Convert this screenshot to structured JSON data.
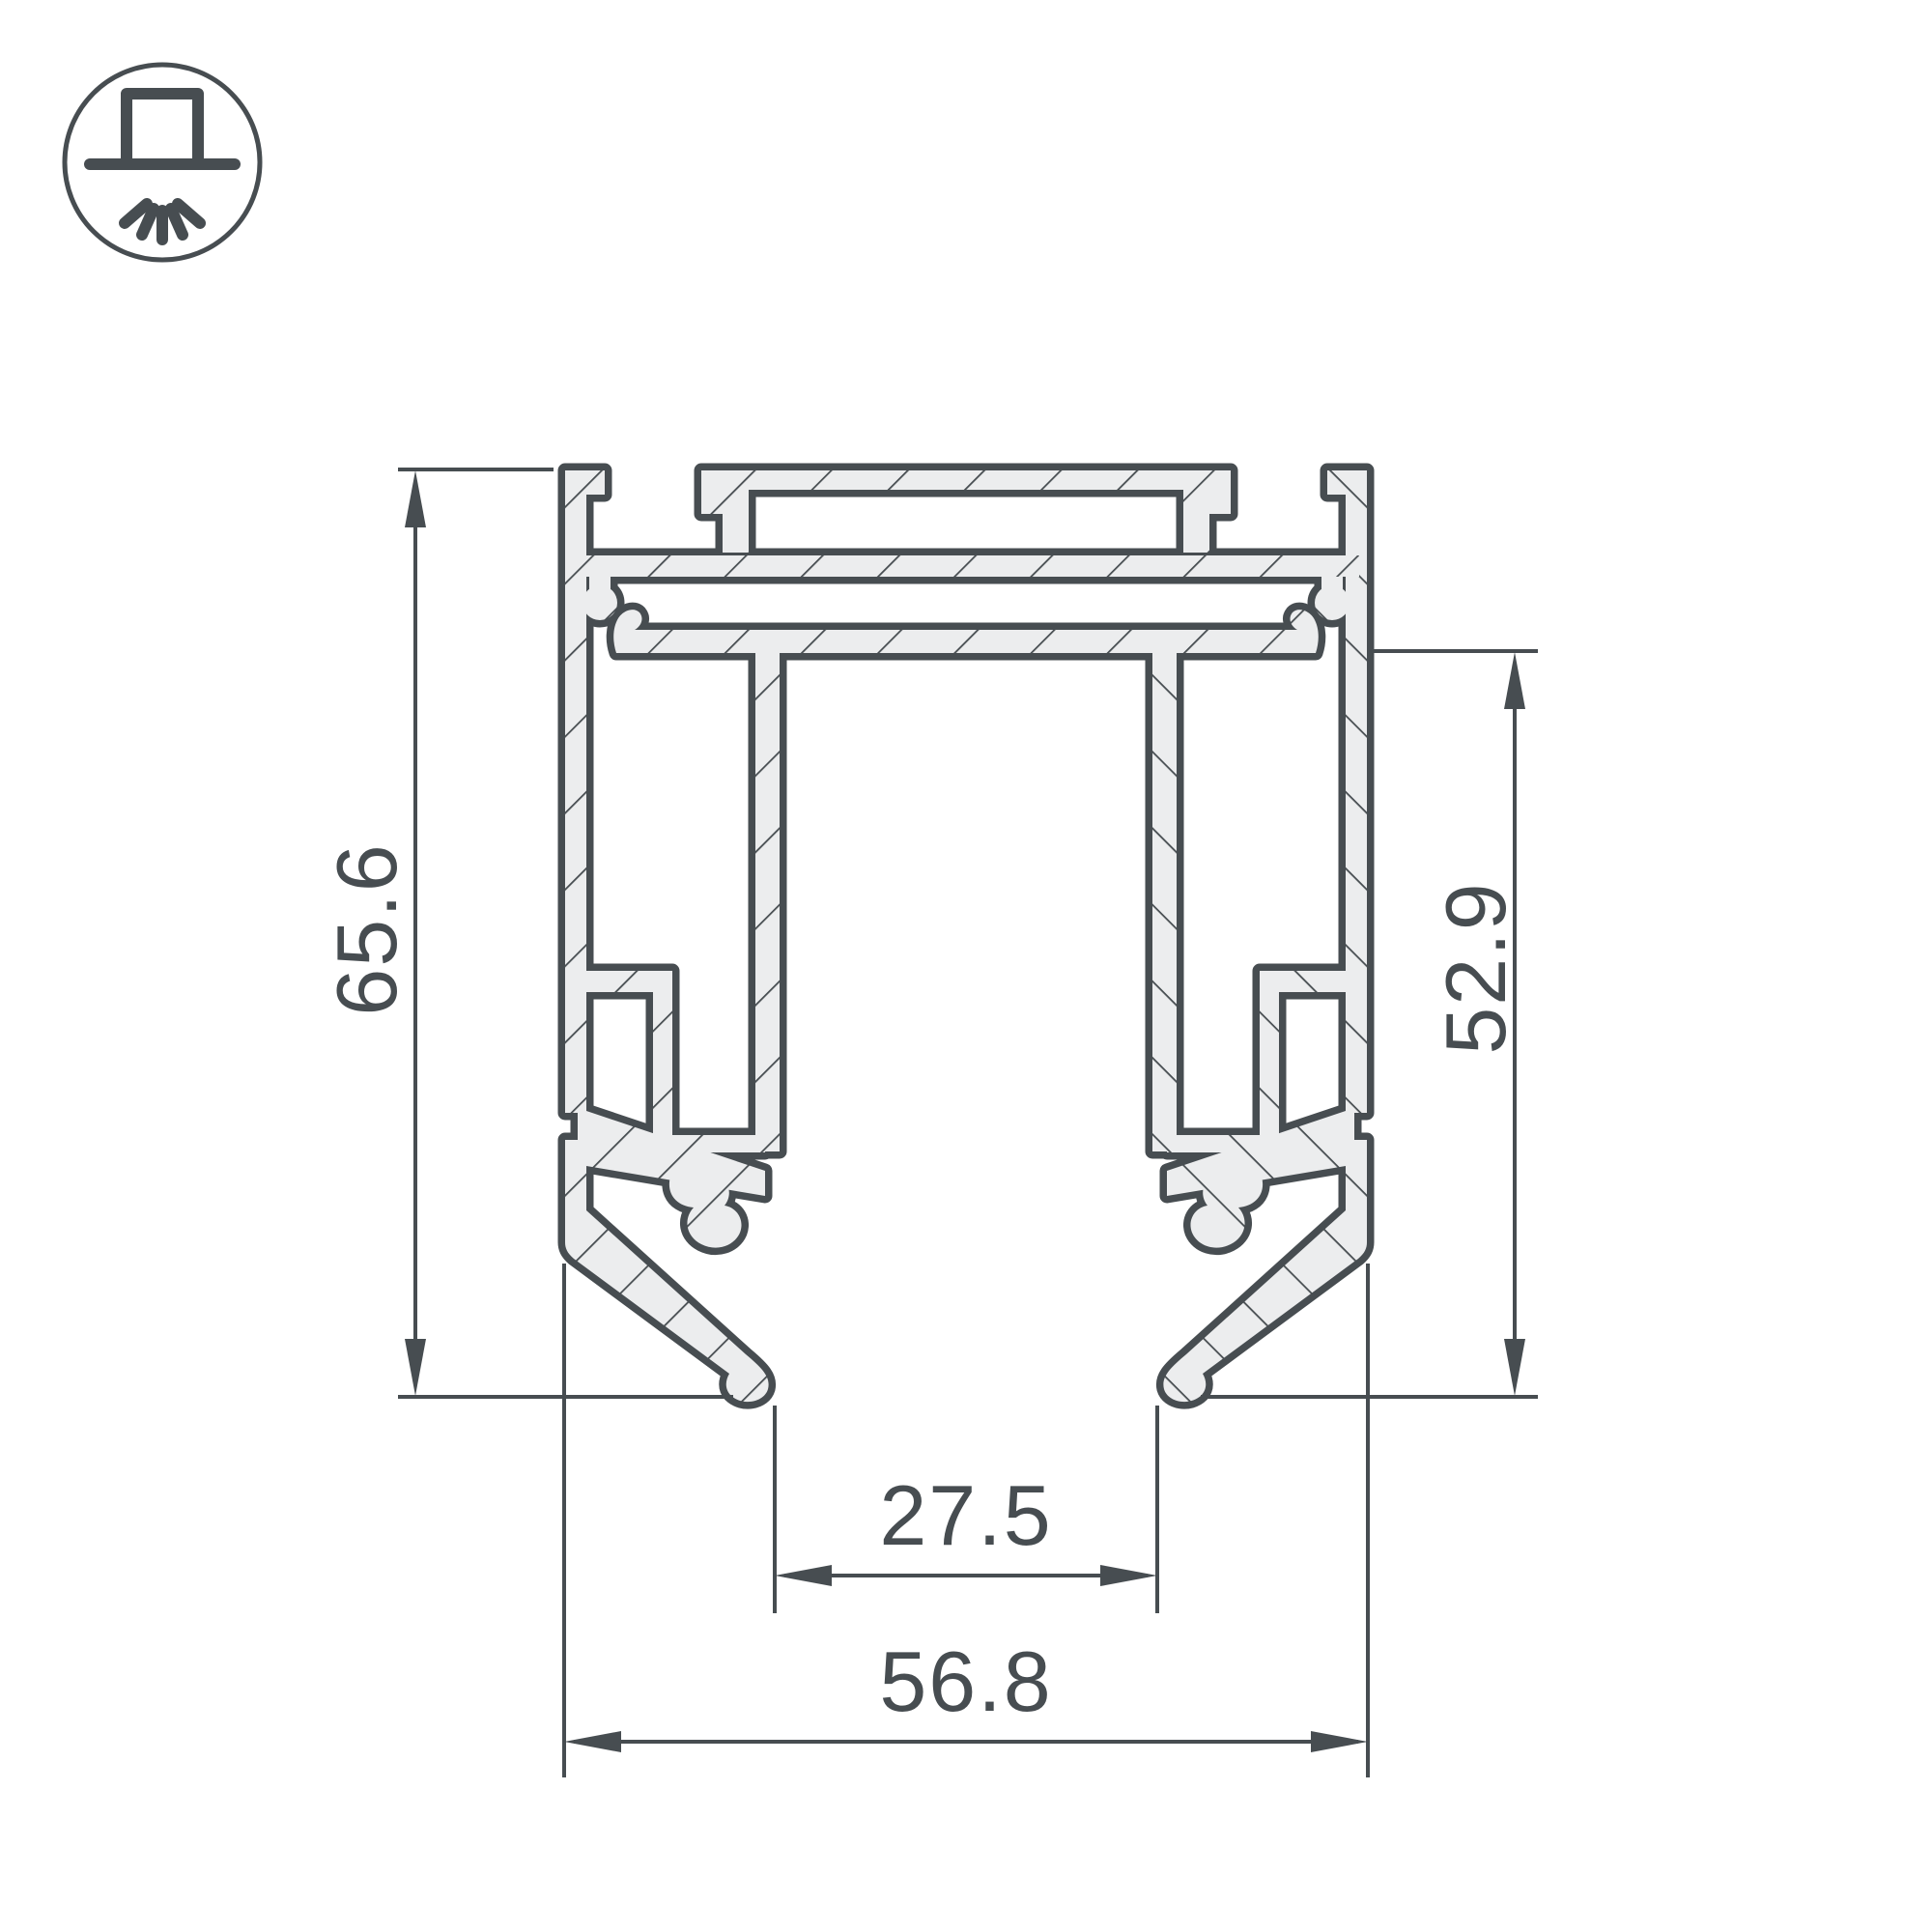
{
  "drawing": {
    "title": "aluminum-profile-cross-section",
    "labels": {
      "overall_height": "65.6",
      "inner_height": "52.9",
      "inner_width": "27.5",
      "overall_width": "56.8"
    }
  },
  "icon": {
    "name": "surface-mounted-luminaire"
  },
  "colors": {
    "line": "#474d51",
    "profile_fill": "#ecedee",
    "background": "#ffffff"
  }
}
